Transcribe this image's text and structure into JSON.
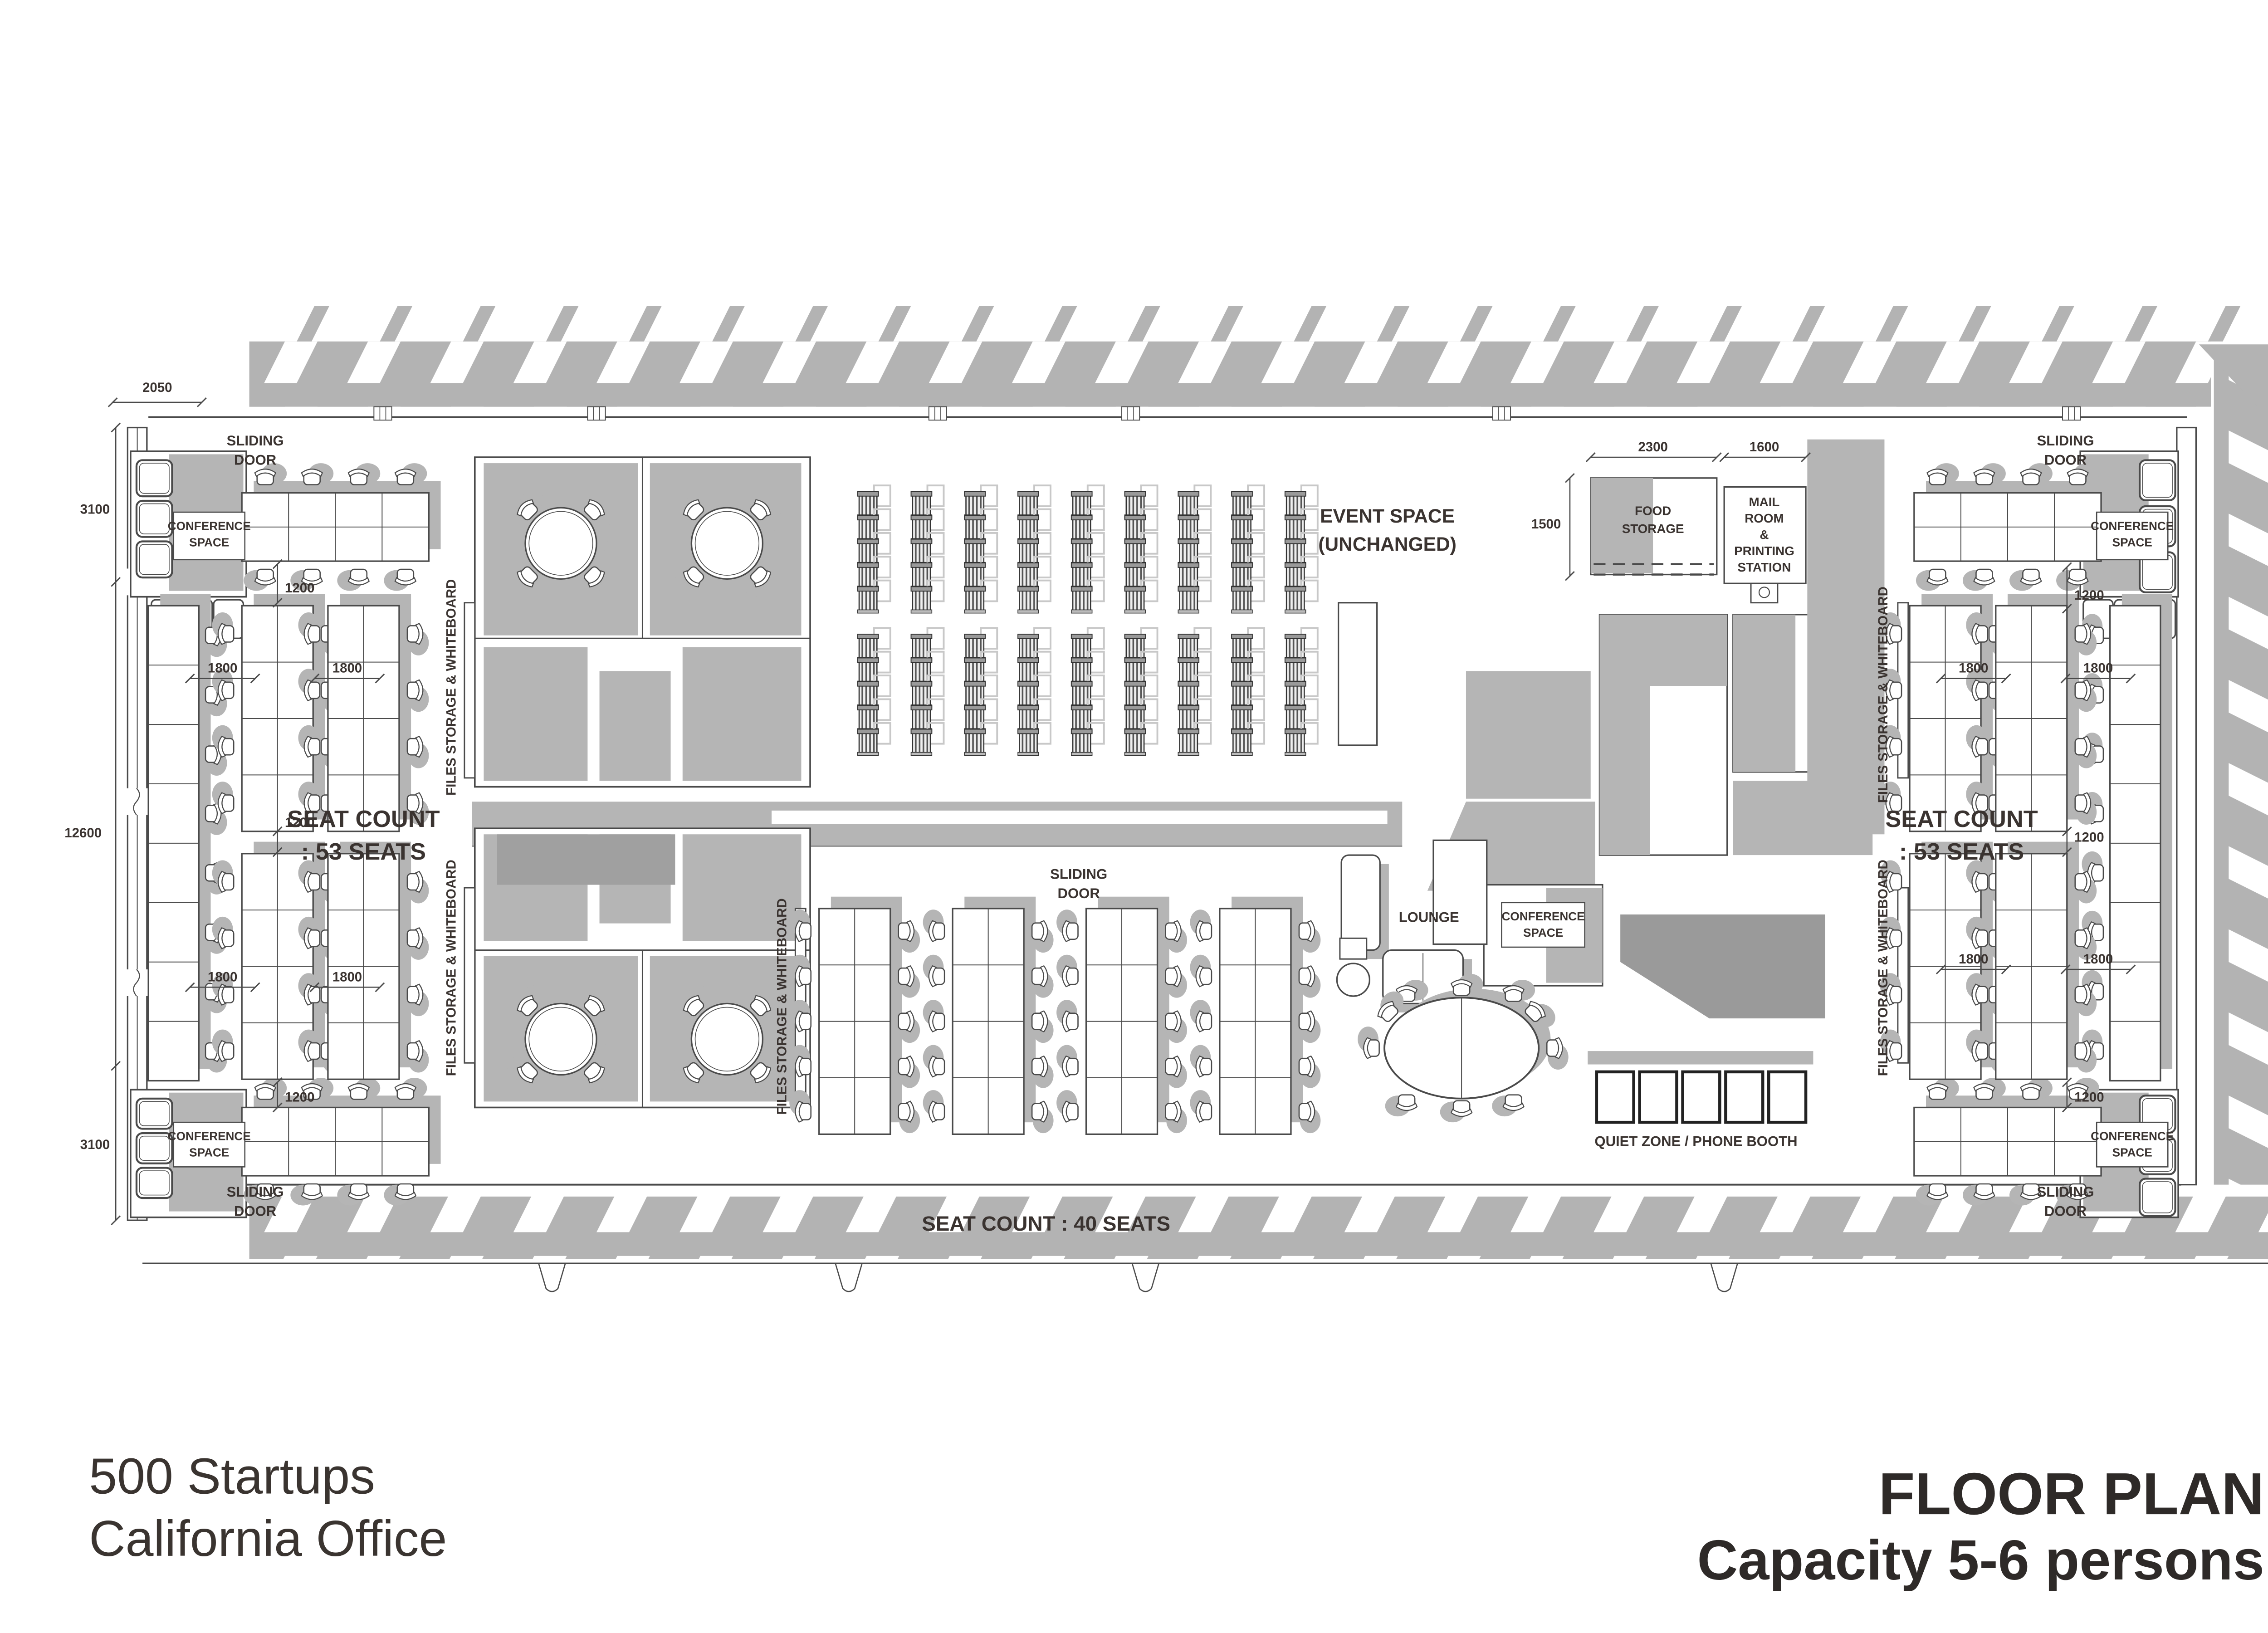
{
  "titles": {
    "project_line1": "500 Startups",
    "project_line2": "California Office",
    "sheet_title": "FLOOR PLAN",
    "sheet_subtitle": "Capacity 5-6 persons"
  },
  "labels": {
    "sliding_door": "SLIDING DOOR",
    "conference_space": "CONFERENCE SPACE",
    "files_storage_whiteboard": "FILES STORAGE & WHITEBOARD",
    "event_space": [
      "EVENT SPACE",
      "(UNCHANGED)"
    ],
    "food_storage": [
      "FOOD",
      "STORAGE"
    ],
    "mail_room": [
      "MAIL",
      "ROOM",
      "&",
      "PRINTING",
      "STATION"
    ],
    "lounge": "LOUNGE",
    "quiet_zone": "QUIET ZONE / PHONE BOOTH",
    "seat_count_side": [
      "SEAT COUNT",
      ": 53 SEATS"
    ],
    "seat_count_bottom": "SEAT COUNT : 40 SEATS"
  },
  "dimensions": {
    "entry_width": "2050",
    "left_top": "3100",
    "left_middle": "12600",
    "left_bottom": "3100",
    "food_depth": "1500",
    "food_width": "2300",
    "mail_width": "1600",
    "aisle": "1200",
    "desk_pitch": "1800"
  },
  "colors": {
    "shadow": "#b5b5b5",
    "hatch": "#b3b3b3",
    "line": "#4a4a4a",
    "dark_shape": "#9a9a9a",
    "counter": "#a0a0a0",
    "text": "#3a3330"
  }
}
